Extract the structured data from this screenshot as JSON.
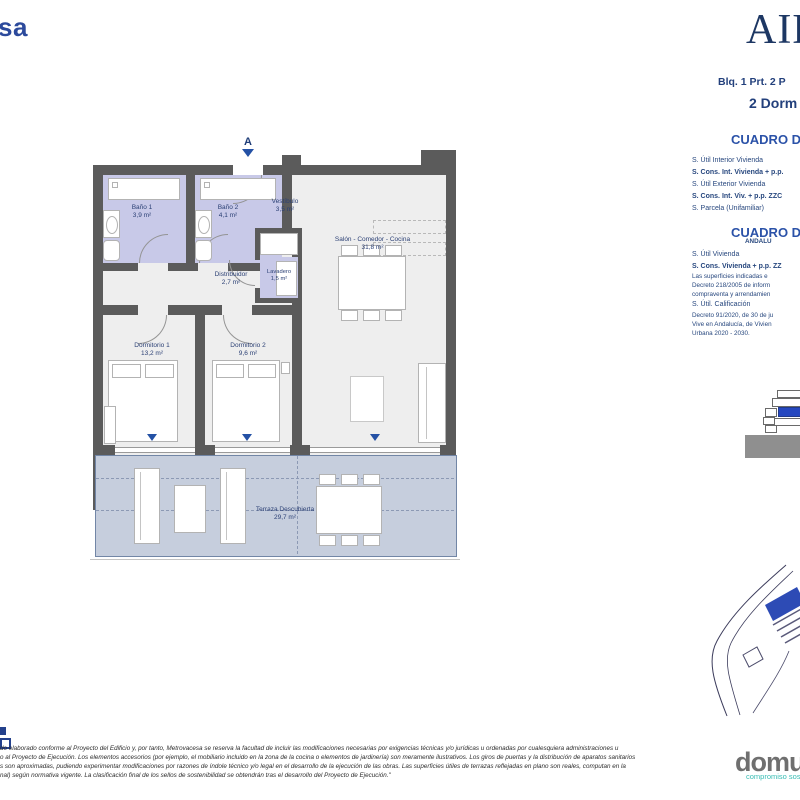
{
  "header": {
    "brand_fragment": "sa",
    "project_logo_fragment": "AIB",
    "block_line": "Blq. 1 Prt. 2 P",
    "bedrooms_line": "2 Dorm"
  },
  "plan": {
    "marker": "A",
    "rooms": [
      {
        "name": "Baño 1",
        "area": "3,9 m²"
      },
      {
        "name": "Baño 2",
        "area": "4,1 m²"
      },
      {
        "name": "Vestíbulo",
        "area": "3,5 m²"
      },
      {
        "name": "Salón - Comedor - Cocina",
        "area": "31,8 m²"
      },
      {
        "name": "Distribuidor",
        "area": "2,7 m²"
      },
      {
        "name": "Lavadero",
        "area": "1,5 m²"
      },
      {
        "name": "Dormitorio 1",
        "area": "13,2 m²"
      },
      {
        "name": "Dormitorio 2",
        "area": "9,6 m²"
      },
      {
        "name": "Terraza Descubierta",
        "area": "29,7 m²"
      }
    ]
  },
  "tables": {
    "general": {
      "title": "CUADRO DE",
      "rows": [
        "S. Útil Interior Vivienda",
        "S. Cons. Int. Vivienda + p.p.",
        "S. Útil Exterior Vivienda",
        "S. Cons. Int. Viv. + p.p. ZZC",
        "S. Parcela (Unifamiliar)"
      ]
    },
    "andalucia": {
      "title": "CUADRO DE",
      "subtitle": "ANDALU",
      "row_util": "S. Útil Vivienda",
      "row_cons": "S. Cons. Vivienda + p.p. ZZ",
      "note1_lines": [
        "Las superficies indicadas e",
        "Decreto 218/2005 de inform",
        "compraventa y arrendamien"
      ],
      "calificacion_label": "S. Útil. Calificación",
      "note2_lines": [
        "Decreto 91/2020, de 30 de ju",
        "Vive en Andalucía, de Vivien",
        "Urbana 2020 - 2030."
      ]
    }
  },
  "footer": {
    "disclaimer_lines": [
      "do elaborado conforme al Proyecto del Edificio y, por tanto, Metrovacesa se reserva la facultad de incluir las modificaciones necesarias por exigencias técnicas y/o jurídicas u ordenadas por cualesquiera administraciones u",
      "o al Proyecto de Ejecución. Los elementos accesorios (por ejemplo, el mobiliario incluido en la zona de la cocina o elementos de jardinería) son meramente ilustrativos. Los giros de puertas y la distribución de aparatos sanitarios",
      "s son aproximadas, pudiendo experimentar modificaciones por razones de índole técnico y/o legal en el desarrollo de la ejecución de las obras. Las superficies útiles de terrazas reflejadas en plano son reales, computan en la",
      "nal) según normativa vigente. La clasificación final de los sellos de sostenibilidad se obtendrán tras el desarrollo del Proyecto de Ejecución.\""
    ],
    "logo_main": "domu",
    "logo_accent": "m",
    "logo_tagline": "compromiso sostenible"
  },
  "colors": {
    "navy_text": "#23407c",
    "cuadro_blue": "#2b52a8",
    "accent_blue": "#2451a5",
    "wall_gray": "#5b5b5b",
    "bath_lavender": "#c8c9e8",
    "terrace_bluegray": "#c6cedd",
    "domum_teal": "#38bdb4",
    "domum_gray": "#6f6f6f"
  }
}
